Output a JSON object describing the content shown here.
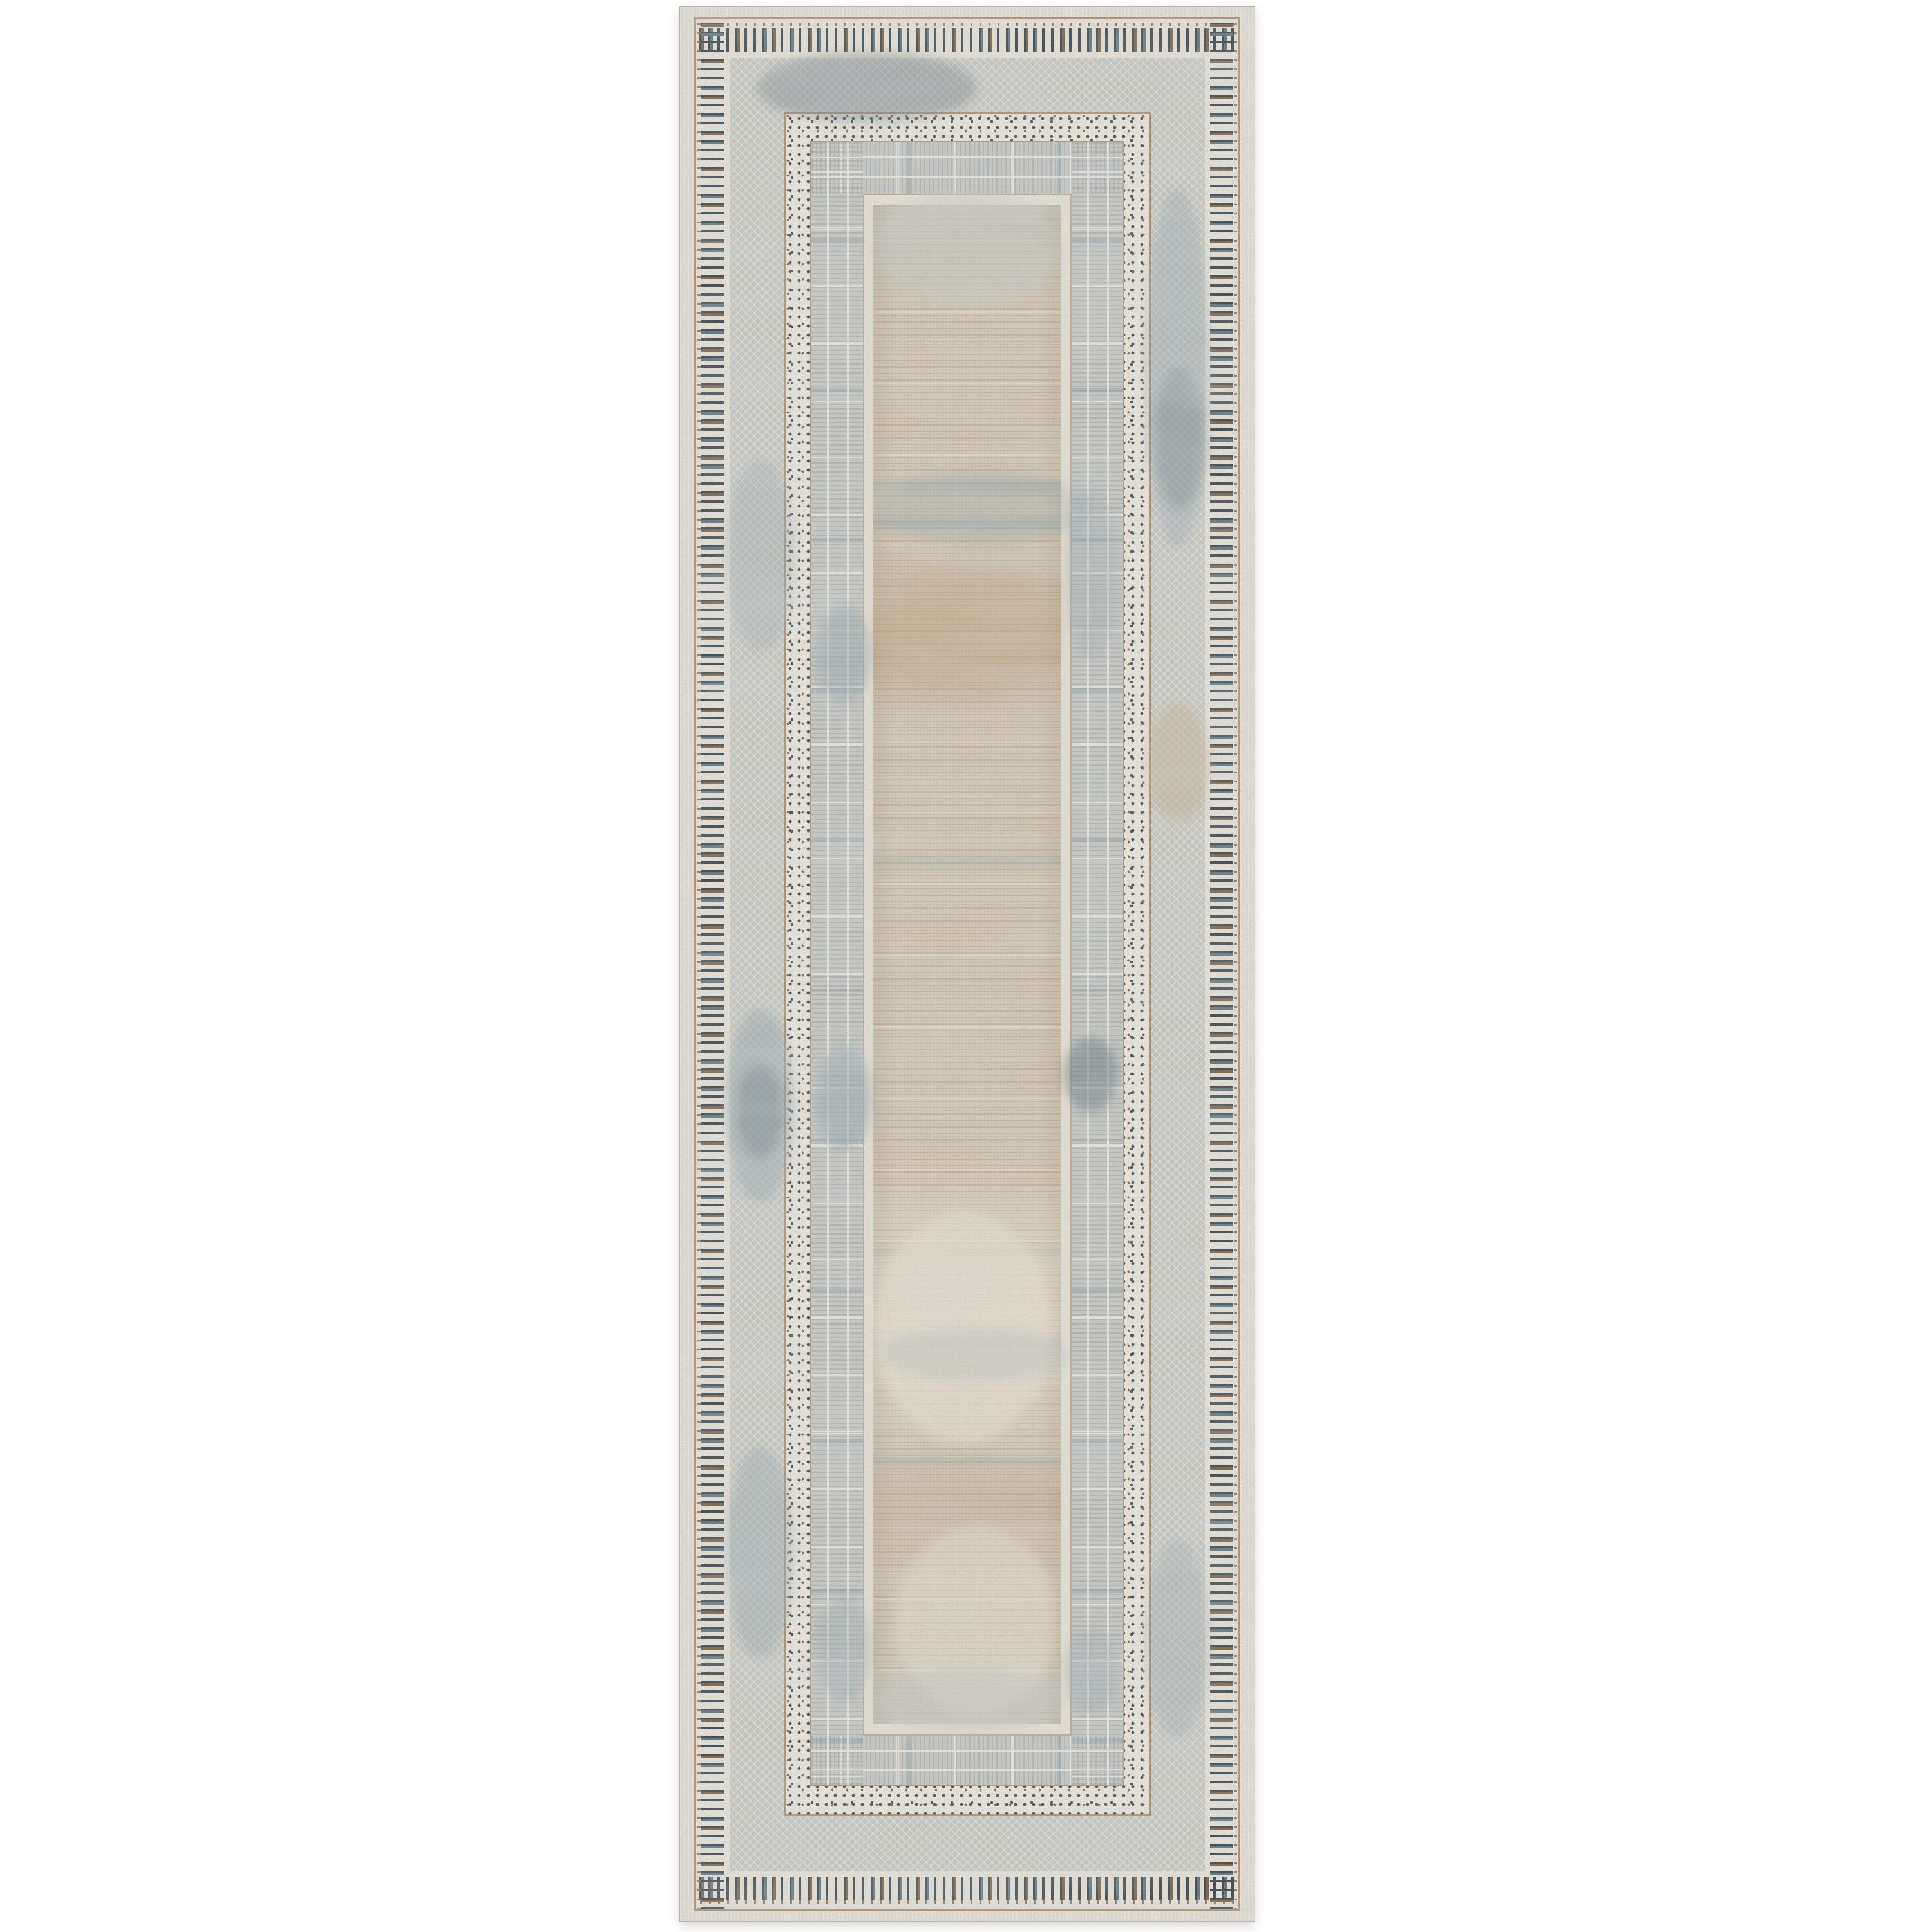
{
  "image": {
    "type": "product-photo",
    "subject": "rectangular runner area rug, photographed flat on white background",
    "orientation": "vertical runner, centered",
    "style": "greige transitional rug with concentric geometric borders and distressed abstract center field",
    "background_color": "#ffffff"
  },
  "rug": {
    "borders_outside_in": [
      "cream binding edge",
      "brown speckled outline",
      "dash-stripe border (dark ticks perpendicular to edge)",
      "gray herringbone band with blue-gray distressed patches",
      "cream dotted border with dark and brown dots",
      "gray hatched band with fine perpendicular lines",
      "cream inner frame",
      "beige abstract striped center field with blue-gray streaks"
    ]
  },
  "palette": {
    "page_bg": "#ffffff",
    "binding": "#e4e0d7",
    "edge_line": "#b9b4aa",
    "brown_line": "#9d7a55",
    "dash_bg": "#e9e5dc",
    "dash_dark": "#3a464f",
    "dash_slate": "#5f7682",
    "dash_brown": "#7c6147",
    "herringbone_base": "#c9cac4",
    "herringbone_light": "#dbdbd5",
    "dot_bg": "#ede9e0",
    "dot_dark": "#3d4b53",
    "dot_brown": "#84664a",
    "stripe_base": "#c9cbc7",
    "stripe_blue": "#8099a8",
    "stripe_cream": "#eeebe2",
    "frame_cream": "#e8e4d9",
    "field_base": "#d4c9b6",
    "field_light": "#ece6d9",
    "field_brown": "#af8f66",
    "patch_blue": "#96a8b0",
    "patch_slate": "#667883",
    "patch_tan": "#c7b293"
  }
}
